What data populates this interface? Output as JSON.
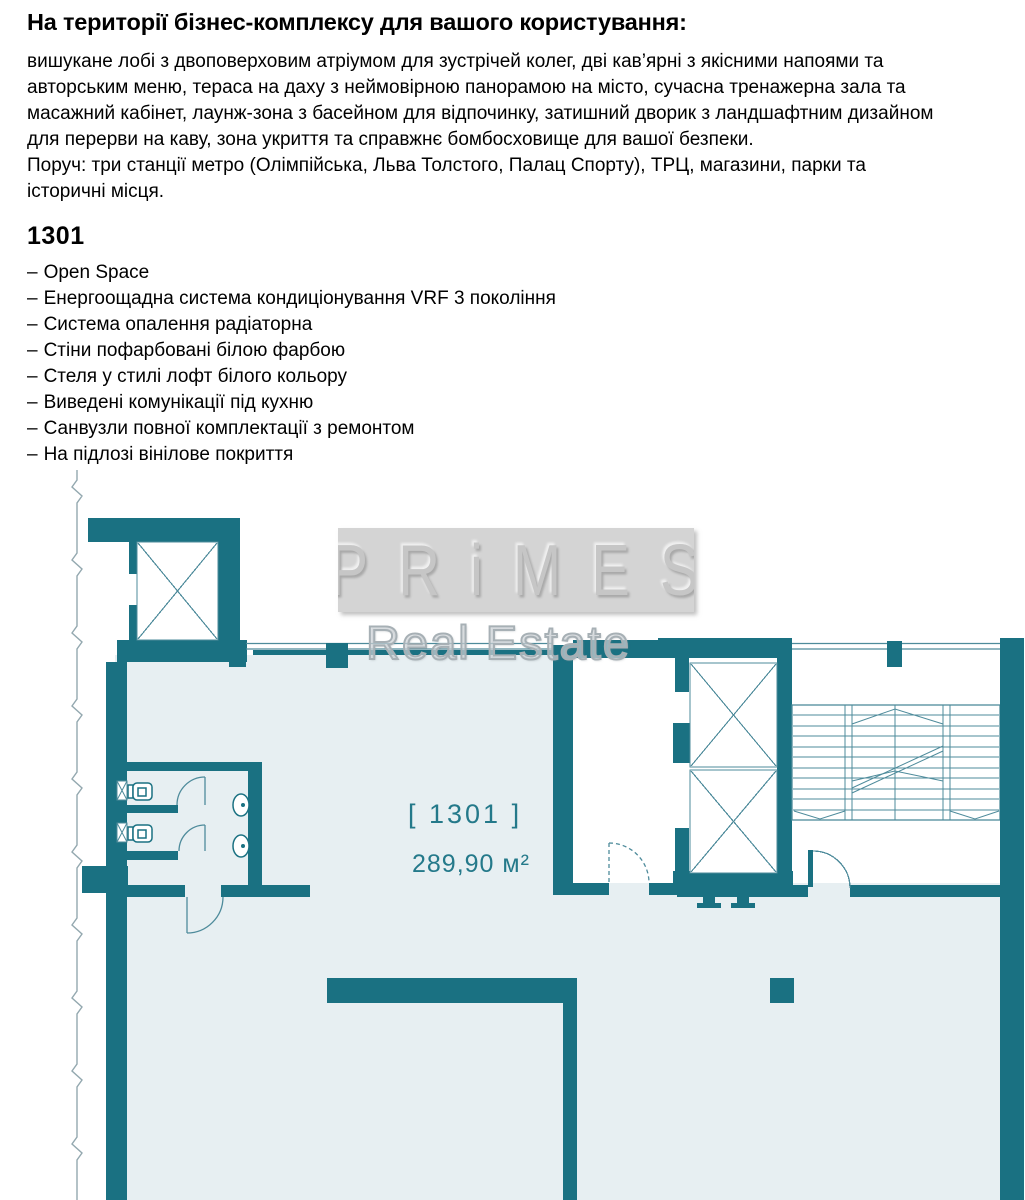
{
  "page": {
    "heading": "На території бізнес-комплексу для вашого користування:",
    "description_lines": [
      "вишукане лобі з двоповерховим атріумом для зустрічей колег, дві кав’ярні з якісними напоями та",
      "авторським меню, тераса на даху з неймовірною панорамою на місто, сучасна тренажерна зала та",
      "масажний кабінет, лаунж-зона з басейном для відпочинку, затишний дворик з ландшафтним дизайном",
      "для перерви на каву, зона укриття та справжнє бомбосховище для вашої безпеки.",
      "Поруч: три станції метро (Олімпійська, Льва Толстого, Палац Спорту), ТРЦ, магазини, парки та",
      "історичні місця."
    ],
    "unit": {
      "title": "1301",
      "bullet": "–",
      "features": [
        "Open Space",
        "Енергоощадна система кондиціонування VRF 3 покоління",
        "Система опалення радіаторна",
        "Стіни пофарбовані білою фарбою",
        "Стеля у стилі лофт білого кольору",
        "Виведені комунікації під кухню",
        "Санвузли повної комплектації з ремонтом",
        "На підлозі вінілове покриття"
      ]
    },
    "floorplan": {
      "watermark": {
        "brand": "PRiMES",
        "subtitle": "Real Estate"
      },
      "unit_label": "[ 1301 ]",
      "area_label": "289,90 м²",
      "colors": {
        "wall": "#1a7182",
        "thin_line": "#4e8b9b",
        "floor": "#e7eff2",
        "label_text": "#24798a"
      }
    }
  }
}
